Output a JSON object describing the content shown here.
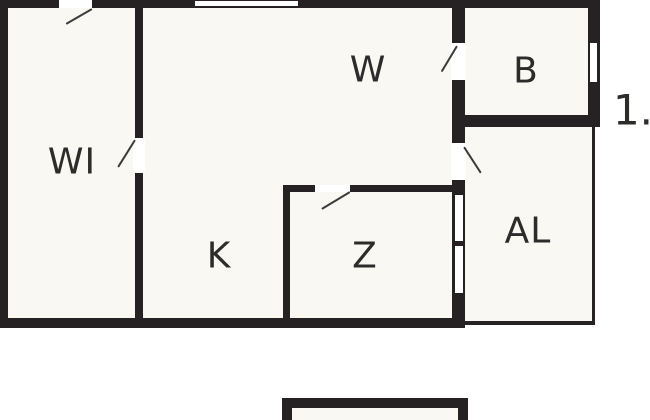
{
  "plan": {
    "floor_label": "1.",
    "rooms": [
      {
        "id": "wi",
        "label": "WI"
      },
      {
        "id": "w",
        "label": "W"
      },
      {
        "id": "b",
        "label": "B"
      },
      {
        "id": "k",
        "label": "K"
      },
      {
        "id": "z",
        "label": "Z"
      },
      {
        "id": "al",
        "label": "AL"
      }
    ],
    "features": {
      "doors": [
        "entry-door-top",
        "wi-door",
        "b-door",
        "al-door",
        "z-door"
      ],
      "windows": [
        "top-wall-window",
        "b-right-window",
        "z-al-window-upper",
        "z-al-window-lower"
      ]
    },
    "colors": {
      "wall": "#262122",
      "room_fill": "#f9f8f2",
      "background": "#ffffff",
      "label": "#2e2c2b",
      "door_swing": "#3b3b3b"
    }
  }
}
